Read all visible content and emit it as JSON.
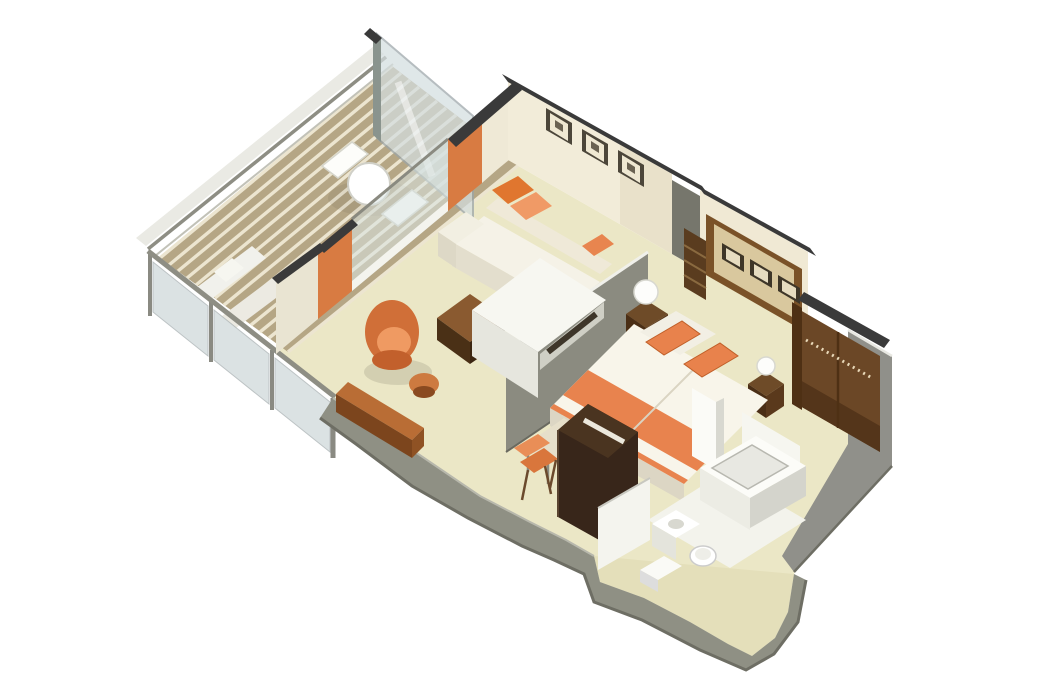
{
  "page": {
    "title": "Cruise suite isometric floor plan",
    "background": "#ffffff"
  },
  "palette": {
    "floor": "#ebe7c6",
    "deck_teak": "#b5a685",
    "deck_stripe": "#ece5d0",
    "wall_cream": "#f2ecd9",
    "wall_gray": "#8b8b80",
    "hull_gray": "#8f9084",
    "cap_dark": "#3a3a3a",
    "glass": "#d4dee0",
    "accent_orange": "#e8834e",
    "orange_deep": "#d06f38",
    "wood_dark": "#38261a",
    "wood_medium": "#8a5a30",
    "wardrobe_brown": "#6b4726",
    "headboard_tan": "#d9c89e",
    "linen_white": "#f5f2e7",
    "fixture_white": "#fcfcf8"
  },
  "scene": {
    "projection": "isometric-cutaway",
    "areas": [
      {
        "id": "balcony",
        "label": "Balcony",
        "furniture": [
          "teak deck",
          "glass railing",
          "glass privacy divider",
          "round table",
          "two deck chairs",
          "loungers"
        ]
      },
      {
        "id": "living-room",
        "label": "Living room",
        "furniture": [
          "sofa",
          "orange throw pillows",
          "coffee table",
          "orange tub chair",
          "ottoman",
          "sideboard",
          "wall art three frames",
          "tv console",
          "sliding glass doors with orange frames"
        ]
      },
      {
        "id": "bedroom",
        "label": "Bedroom",
        "furniture": [
          "double bed with orange runner",
          "orange pillows",
          "headboard wall with three frames",
          "bookshelf",
          "left nightstand",
          "right nightstand",
          "table lamps",
          "tv cabinet",
          "desk",
          "orange desk chair"
        ]
      },
      {
        "id": "wardrobe",
        "label": "Walk-in wardrobe",
        "furniture": [
          "hanging rail"
        ]
      },
      {
        "id": "bathroom",
        "label": "Bathroom",
        "furniture": [
          "bathtub",
          "vanity sink",
          "toilet",
          "step"
        ]
      }
    ]
  }
}
